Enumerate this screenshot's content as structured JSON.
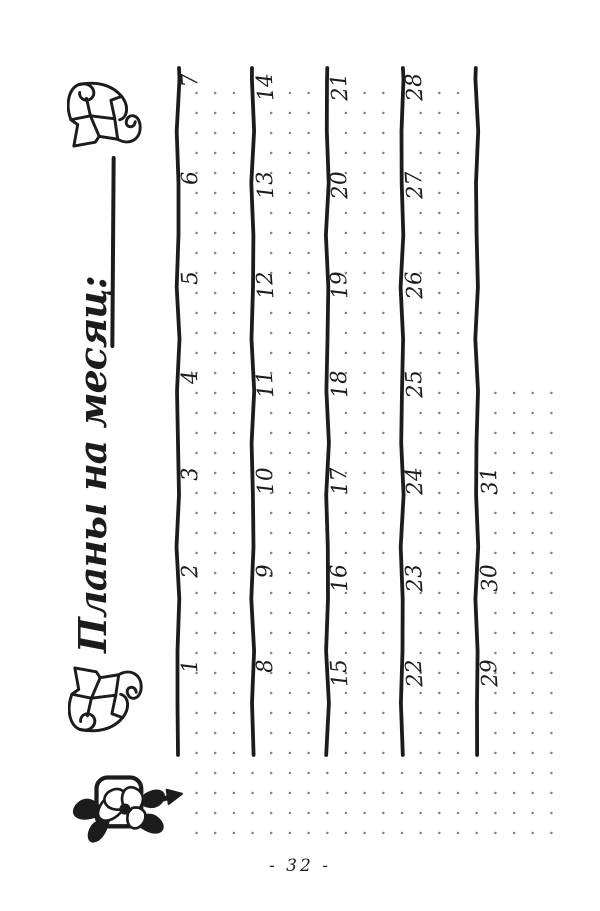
{
  "page": {
    "title": "Планы на месяц:",
    "page_number": "- 32 -"
  },
  "calendar": {
    "weeks": [
      {
        "days": [
          "1",
          "2",
          "3",
          "4",
          "5",
          "6",
          "7"
        ]
      },
      {
        "days": [
          "8",
          "9",
          "10",
          "11",
          "12",
          "13",
          "14"
        ]
      },
      {
        "days": [
          "15",
          "16",
          "17",
          "18",
          "19",
          "20",
          "21"
        ]
      },
      {
        "days": [
          "22",
          "23",
          "24",
          "25",
          "26",
          "27",
          "28"
        ]
      },
      {
        "days": [
          "29",
          "30",
          "31"
        ]
      }
    ]
  },
  "icons": {
    "header_flower": "lily-flower-icon",
    "header_knot_left": "corner-knot-left-icon",
    "header_knot_right": "corner-knot-right-icon"
  },
  "colors": {
    "ink": "#1c1c1c",
    "dot": "#828282",
    "paper": "#ffffff"
  }
}
